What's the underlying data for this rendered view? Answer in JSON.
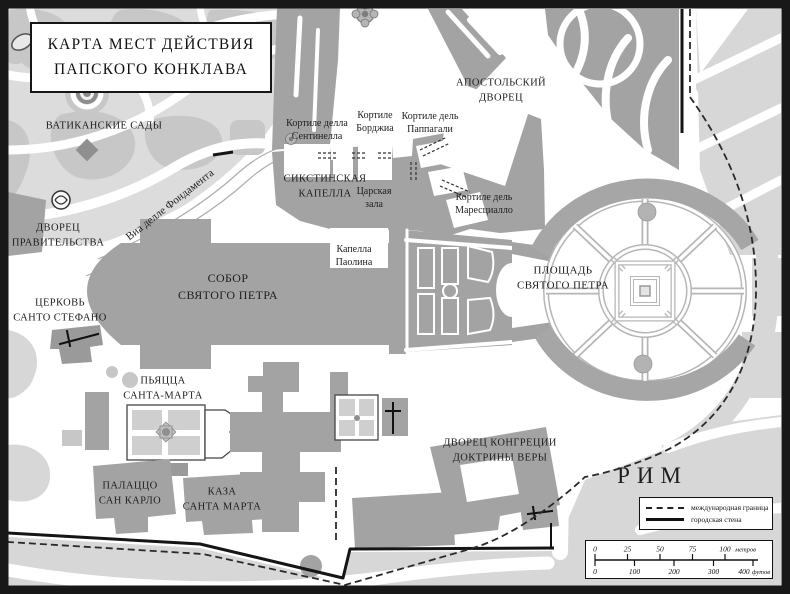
{
  "title": "КАРТА МЕСТ ДЕЙСТВИЯ\nПАПСКОГО КОНКЛАВА",
  "places": {
    "vatican_gardens": "ВАТИКАНСКИЕ САДЫ",
    "government_palace": "ДВОРЕЦ\nПРАВИТЕЛЬСТВА",
    "church_santo_stefano": "ЦЕРКОВЬ\nСАНТО СТЕФАНО",
    "via_delle_fondamenta": "Виа делле Фондамента",
    "cortile_della_sentinella": "Кортиле делла\nСентинелла",
    "cortile_borgia": "Кортиле\nБорджиа",
    "cortile_del_pappagalli": "Кортиле дель\nПаппагали",
    "apostolic_palace": "АПОСТОЛЬСКИЙ\nДВОРЕЦ",
    "sistine_chapel": "СИКСТИНСКАЯ\nКАПЕЛЛА",
    "sala_regia": "Царская\nзала",
    "cortile_del_maresciallo": "Кортиле дель\nМаресциалло",
    "cappella_paolina": "Капелла\nПаолина",
    "st_peters_basilica": "СОБОР\nСВЯТОГО ПЕТРА",
    "st_peters_square": "ПЛОЩАДЬ\nСВЯТОГО ПЕТРА",
    "piazza_santa_marta": "ПЬЯЦЦА\nСАНТА-МАРТА",
    "palazzo_san_carlo": "ПАЛАЦЦО\nСАН КАРЛО",
    "casa_santa_marta": "КАЗА\nСАНТА МАРТА",
    "congregation_palace": "ДВОРЕЦ КОНГРЕЦИИ\nДОКТРИНЫ ВЕРЫ",
    "rome": "РИМ"
  },
  "legend": {
    "international_border": "международная граница",
    "city_wall": "городская стена"
  },
  "scale_bar": {
    "meters": {
      "ticks": [
        "0",
        "25",
        "50",
        "75",
        "100"
      ],
      "unit": "метров"
    },
    "feet": {
      "ticks": [
        "0",
        "100",
        "200",
        "300",
        "400"
      ],
      "unit": "футов"
    }
  },
  "colors": {
    "background": "#ffffff",
    "building": "#a3a3a3",
    "garden": "#dcdcdc",
    "garden_blob": "#c7c7c7",
    "rome_block": "#d7d7d7",
    "colonnade": "#a6a6a6",
    "plaza_line": "#b6b6b6",
    "wall": "#151515",
    "border_dash": "#2a2a2a"
  }
}
